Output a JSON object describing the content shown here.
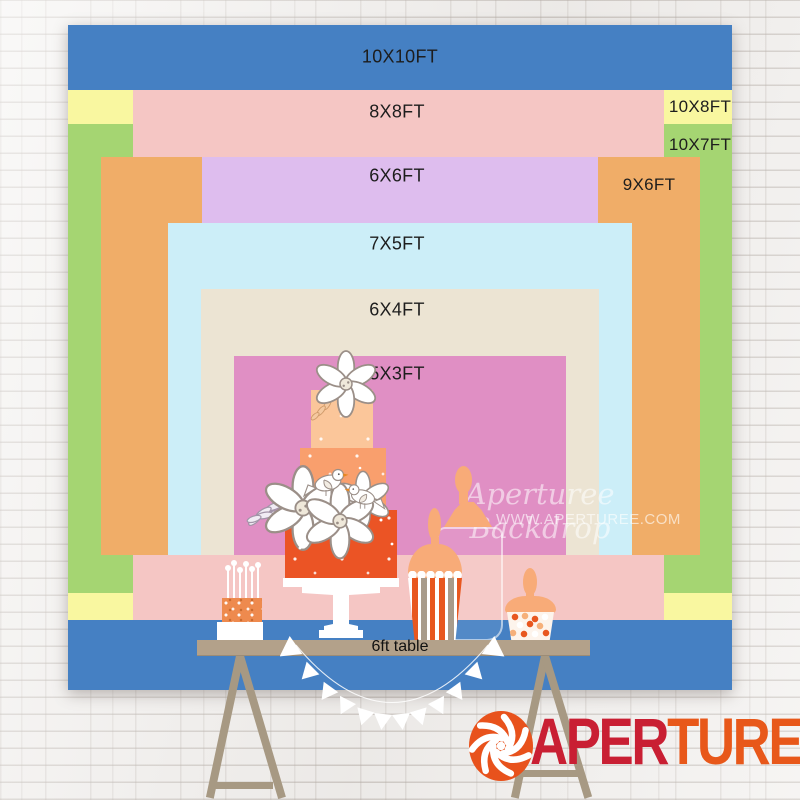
{
  "backdrop_sizes": [
    {
      "label": "10X10FT",
      "color": "#4580c3",
      "x": 68,
      "y": 25,
      "w": 664,
      "h": 665,
      "lx": 400,
      "ly": 57,
      "fs": 18
    },
    {
      "label": "10X8FT",
      "color": "#f9f7a0",
      "x": 68,
      "y": 90,
      "w": 664,
      "h": 530,
      "lx": 700,
      "ly": 107,
      "fs": 17
    },
    {
      "label": "10X7FT",
      "color": "#a5d572",
      "x": 68,
      "y": 124,
      "w": 664,
      "h": 469,
      "lx": 700,
      "ly": 145,
      "fs": 17
    },
    {
      "label": "8X8FT",
      "color": "#f5c6c4",
      "x": 133,
      "y": 90,
      "w": 531,
      "h": 530,
      "lx": 397,
      "ly": 112,
      "fs": 18
    },
    {
      "label": "9X6FT",
      "color": "#f0ad68",
      "x": 101,
      "y": 157,
      "w": 599,
      "h": 398,
      "lx": 649,
      "ly": 185,
      "fs": 17
    },
    {
      "label": "6X6FT",
      "color": "#debdee",
      "x": 202,
      "y": 157,
      "w": 396,
      "h": 398,
      "lx": 397,
      "ly": 176,
      "fs": 18
    },
    {
      "label": "7X5FT",
      "color": "#cceef8",
      "x": 168,
      "y": 223,
      "w": 464,
      "h": 332,
      "lx": 397,
      "ly": 244,
      "fs": 18
    },
    {
      "label": "6X4FT",
      "color": "#ece4d3",
      "x": 201,
      "y": 289,
      "w": 398,
      "h": 266,
      "lx": 397,
      "ly": 310,
      "fs": 18
    },
    {
      "label": "5X3FT",
      "color": "#e08fc4",
      "x": 234,
      "y": 356,
      "w": 332,
      "h": 199,
      "lx": 397,
      "ly": 374,
      "fs": 18
    }
  ],
  "table": {
    "label": "6ft table"
  },
  "watermark": {
    "line1": "Aperturee Backdrop",
    "line2": "WWW.APERTUREE.COM"
  },
  "logo": {
    "part1": "APER",
    "part2": "TUREE",
    "part1_color": "#c91f33",
    "part2_color": "#e8581a",
    "icon": "aperture-icon",
    "icon_color": "#e8521c"
  },
  "palette": {
    "wall": "#f3f1ef",
    "label_text": "#1d1d1d",
    "table_wood": "#b3a18a",
    "trestle": "#a79983",
    "cake_tier_top": "#fbc69a",
    "cake_tier_mid": "#f99f6d",
    "cake_tier_bottom": "#eb5425",
    "candle_cake": "#ee8a4e",
    "jar_lid_peach": "#f8ab78",
    "stripe_orange": "#e8571f",
    "stripe_taupe": "#a89b8b"
  },
  "scene": {
    "items": [
      "tiered-cake",
      "candle-cake",
      "striped-candy-jar",
      "glass-apothecary-jar",
      "candy-cup-jar",
      "dessert-table",
      "trestle-legs",
      "bunting-garland"
    ]
  }
}
